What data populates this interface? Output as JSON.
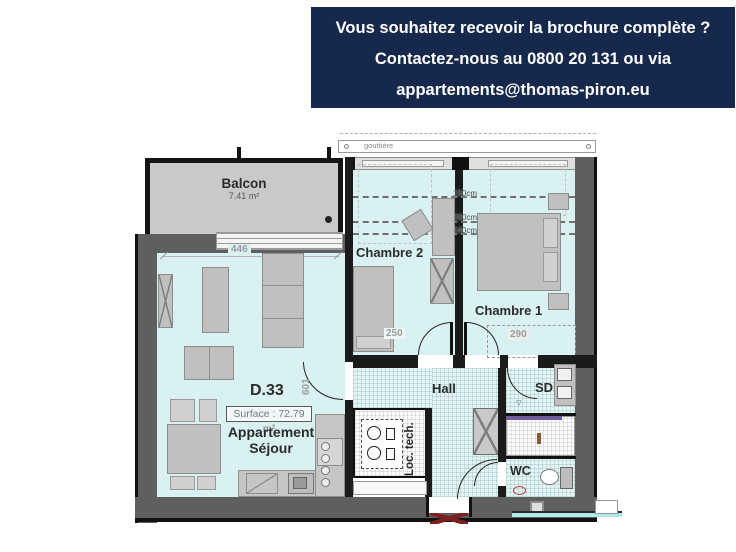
{
  "banner": {
    "bg": "#16294d",
    "lines": [
      "Vous souhaitez recevoir la brochure complète ?",
      "Contactez-nous au 0800 20 131 ou via",
      "appartements@thomas-piron.eu"
    ]
  },
  "plan": {
    "colors": {
      "floor": "#d9f1f1",
      "wall": "#5f5f5f",
      "wall_dark": "#1b1b1b",
      "balcony_floor": "#c9c9c9",
      "furniture": "#c0c0c0",
      "entrance_marker_red": "#7c2020",
      "shower_accent": "#6f5a9e"
    },
    "gutter_label": "gouttière",
    "height_markers": [
      "150cm",
      "200cm",
      "240cm"
    ],
    "dims": {
      "sejour_width": "446",
      "sejour_depth": "601",
      "chambre2_width": "250",
      "chambre1_width": "290"
    },
    "rooms": {
      "balcon": {
        "label": "Balcon",
        "area": "7.41 m²"
      },
      "sejour": {
        "unit": "D.33",
        "surface": "Surface : 72.79 m²",
        "name_line1": "Appartement",
        "name_line2": "Séjour"
      },
      "chambre2": {
        "label": "Chambre 2"
      },
      "chambre1": {
        "label": "Chambre 1"
      },
      "hall": {
        "label": "Hall"
      },
      "sdd": {
        "label": "SDD"
      },
      "wc": {
        "label": "WC"
      },
      "loctech": {
        "label": "Loc. tech."
      }
    }
  }
}
